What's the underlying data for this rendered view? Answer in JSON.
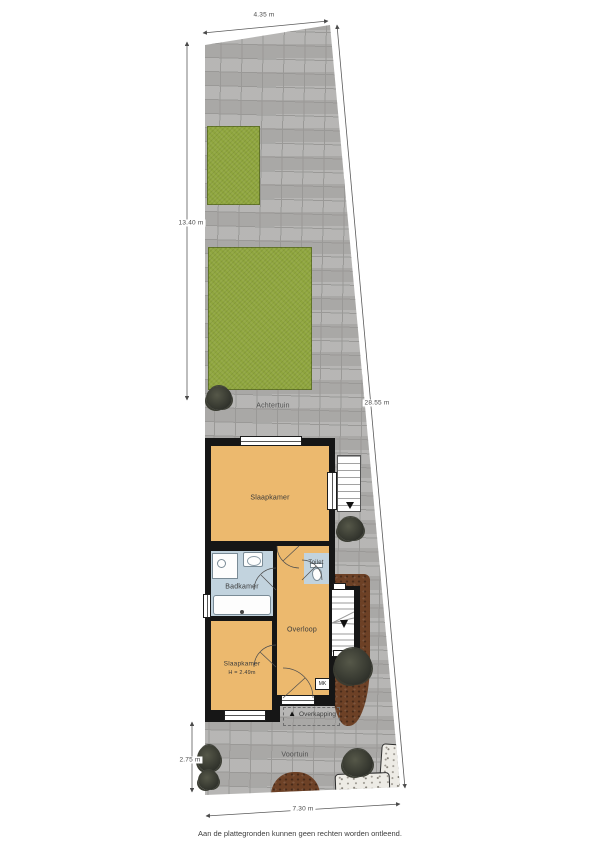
{
  "page": {
    "caption": "Aan de plattegronden kunnen geen rechten worden ontleend."
  },
  "dimensions": {
    "top": "4.35 m",
    "left_upper": "13.40 m",
    "right": "28.55 m",
    "left_lower": "2.75 m",
    "bottom": "7.30 m"
  },
  "areas": {
    "back_garden": "Achtertuin",
    "front_garden": "Voortuin",
    "canopy": "Overkapping",
    "canopy_marker": "▲"
  },
  "rooms": {
    "bedroom_main": "Slaapkamer",
    "bathroom": "Badkamer",
    "toilet": "Toilet",
    "landing": "Overloop",
    "bedroom_small": "Slaapkamer",
    "bedroom_small_height": "H = 2.49m",
    "meter_box": "MK"
  },
  "colors": {
    "paving": "#b2b1af",
    "paving-line": "#9a9997",
    "grass": "#8fa63e",
    "room": "#ecb96e",
    "wet-room": "#c2d3de",
    "wall": "#161616",
    "soil": "#6d4126",
    "foliage": "#35372f",
    "gravel": "#edebe5",
    "dim-text": "#4a4a4a"
  }
}
